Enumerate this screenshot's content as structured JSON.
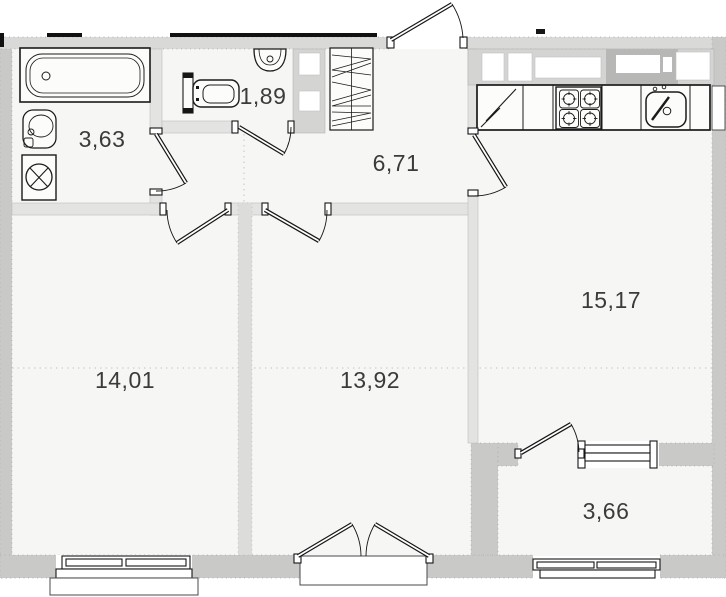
{
  "rooms": {
    "bathroom": {
      "area": "3,63"
    },
    "wc": {
      "area": "1,89"
    },
    "hallway": {
      "area": "6,71"
    },
    "bedroom": {
      "area": "14,01"
    },
    "living_room": {
      "area": "13,92"
    },
    "kitchen_living": {
      "area": "15,17"
    },
    "balcony": {
      "area": "3,66"
    }
  },
  "fixtures": [
    "bathtub",
    "washbasin",
    "washing-machine",
    "toilet",
    "wc-washbasin",
    "wardrobe",
    "fridge",
    "stove",
    "kitchen-sink"
  ],
  "colors": {
    "room_fill": "#f6f6f5",
    "wall_exterior": "#c9c9c8",
    "wall_top": "#d9d9d8",
    "wall_interior": "#e3e3e2",
    "duct_dark": "#b7b7b6",
    "outline": "#161616",
    "label": "#3b3b3b"
  }
}
